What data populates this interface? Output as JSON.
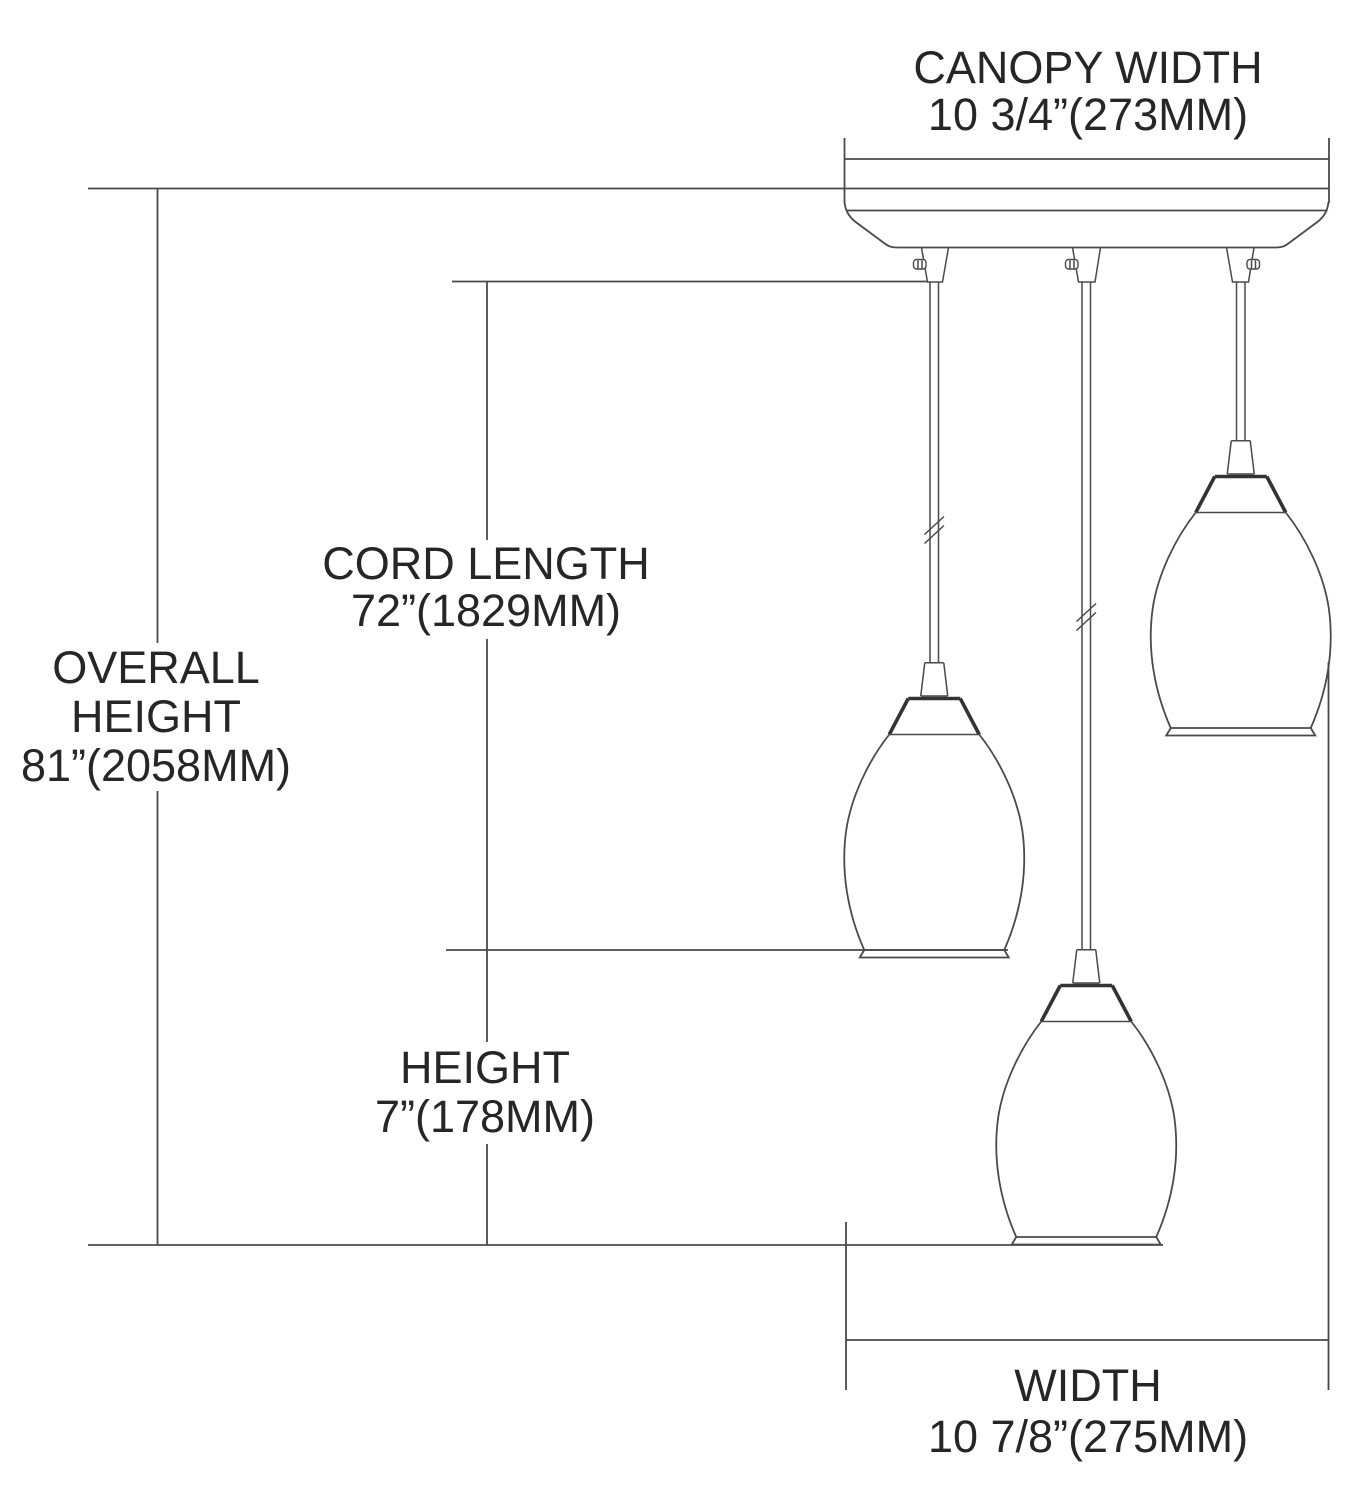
{
  "drawing_title": "3-light multi pendant fixture dimension diagram",
  "labels": {
    "canopy_width": {
      "line1": "CANOPY WIDTH",
      "line2": "10 3/4”(273MM)"
    },
    "overall_height": {
      "line1": "OVERALL",
      "line2": "HEIGHT",
      "line3": "81”(2058MM)"
    },
    "cord_length": {
      "line1": "CORD LENGTH",
      "line2": "72”(1829MM)"
    },
    "shade_height": {
      "line1": "HEIGHT",
      "line2": "7”(178MM)"
    },
    "width": {
      "line1": "WIDTH",
      "line2": "10 7/8”(275MM)"
    }
  },
  "colors": {
    "background": "#ffffff",
    "line": "#4a4a4a",
    "line_bold": "#333333",
    "text": "#262626"
  }
}
